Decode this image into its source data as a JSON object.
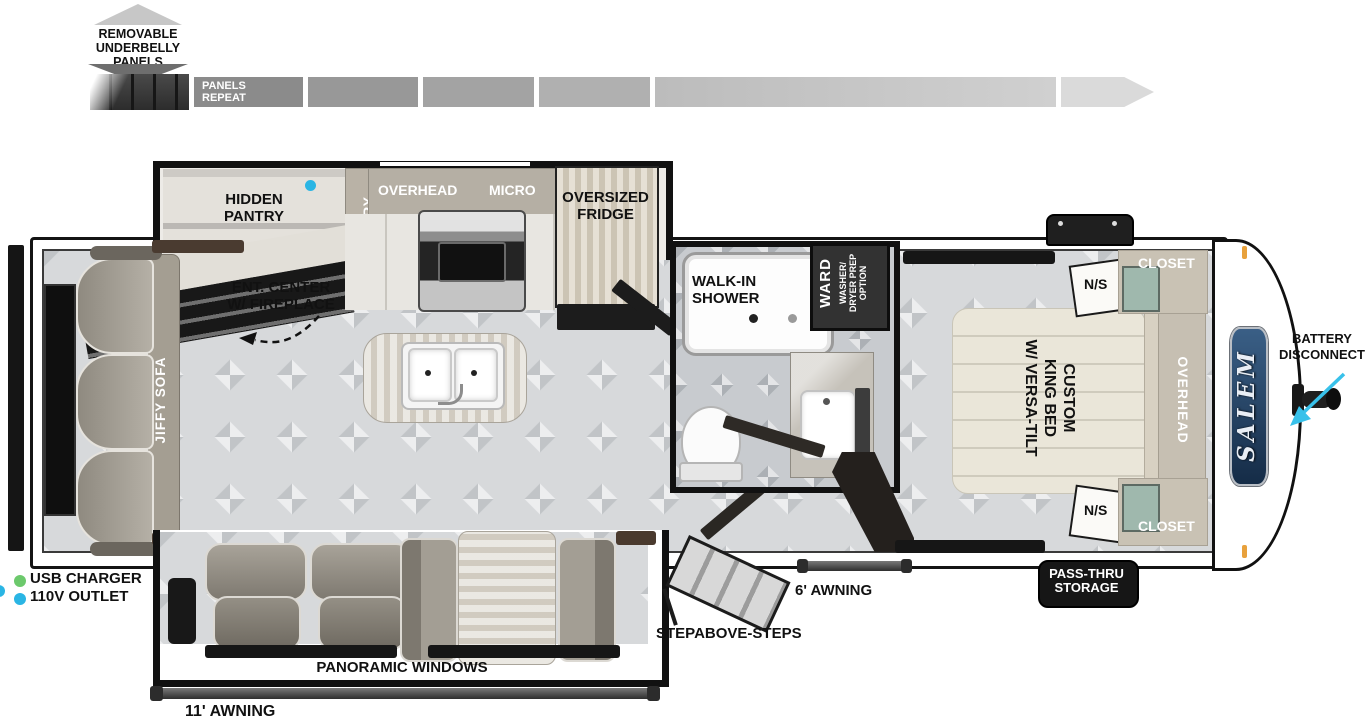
{
  "colors": {
    "accent_cyan": "#2ab5e4",
    "accent_green": "#6cc96c",
    "salem_badge_blue": "#1d3c63",
    "wall_black": "#141414"
  },
  "underbelly": {
    "title": "REMOVABLE UNDERBELLY PANELS",
    "panels_repeat": "PANELS REPEAT"
  },
  "kitchen": {
    "hidden_pantry": "HIDDEN PANTRY",
    "pantry": "PANTRY",
    "overhead": "OVERHEAD",
    "micro": "MICRO",
    "fridge": "OVERSIZED FRIDGE",
    "ent_center": "ENT. CENTER W/ FIREPLACE"
  },
  "living": {
    "sofa": "JIFFY SOFA",
    "panoramic_windows": "PANORAMIC WINDOWS"
  },
  "bath": {
    "shower": "WALK-IN SHOWER",
    "ward": "WARD",
    "washer_l1": "WASHER/",
    "washer_l2": "DRYER PREP",
    "washer_l3": "OPTION"
  },
  "bedroom": {
    "ns_top": "N/S",
    "ns_bottom": "N/S",
    "closet_top": "CLOSET",
    "closet_bottom": "CLOSET",
    "overhead": "OVERHEAD",
    "bed_l1": "CUSTOM",
    "bed_l2": "KING BED",
    "bed_l3": "W/ VERSA-TILT"
  },
  "exterior": {
    "awning_11": "11' AWNING",
    "awning_6": "6' AWNING",
    "steps": "STEPABOVE-STEPS",
    "pass_thru": "PASS-THRU STORAGE",
    "battery": "BATTERY DISCONNECT",
    "brand": "SALEM"
  },
  "legend": {
    "usb": "USB CHARGER",
    "outlet": "110V OUTLET"
  }
}
